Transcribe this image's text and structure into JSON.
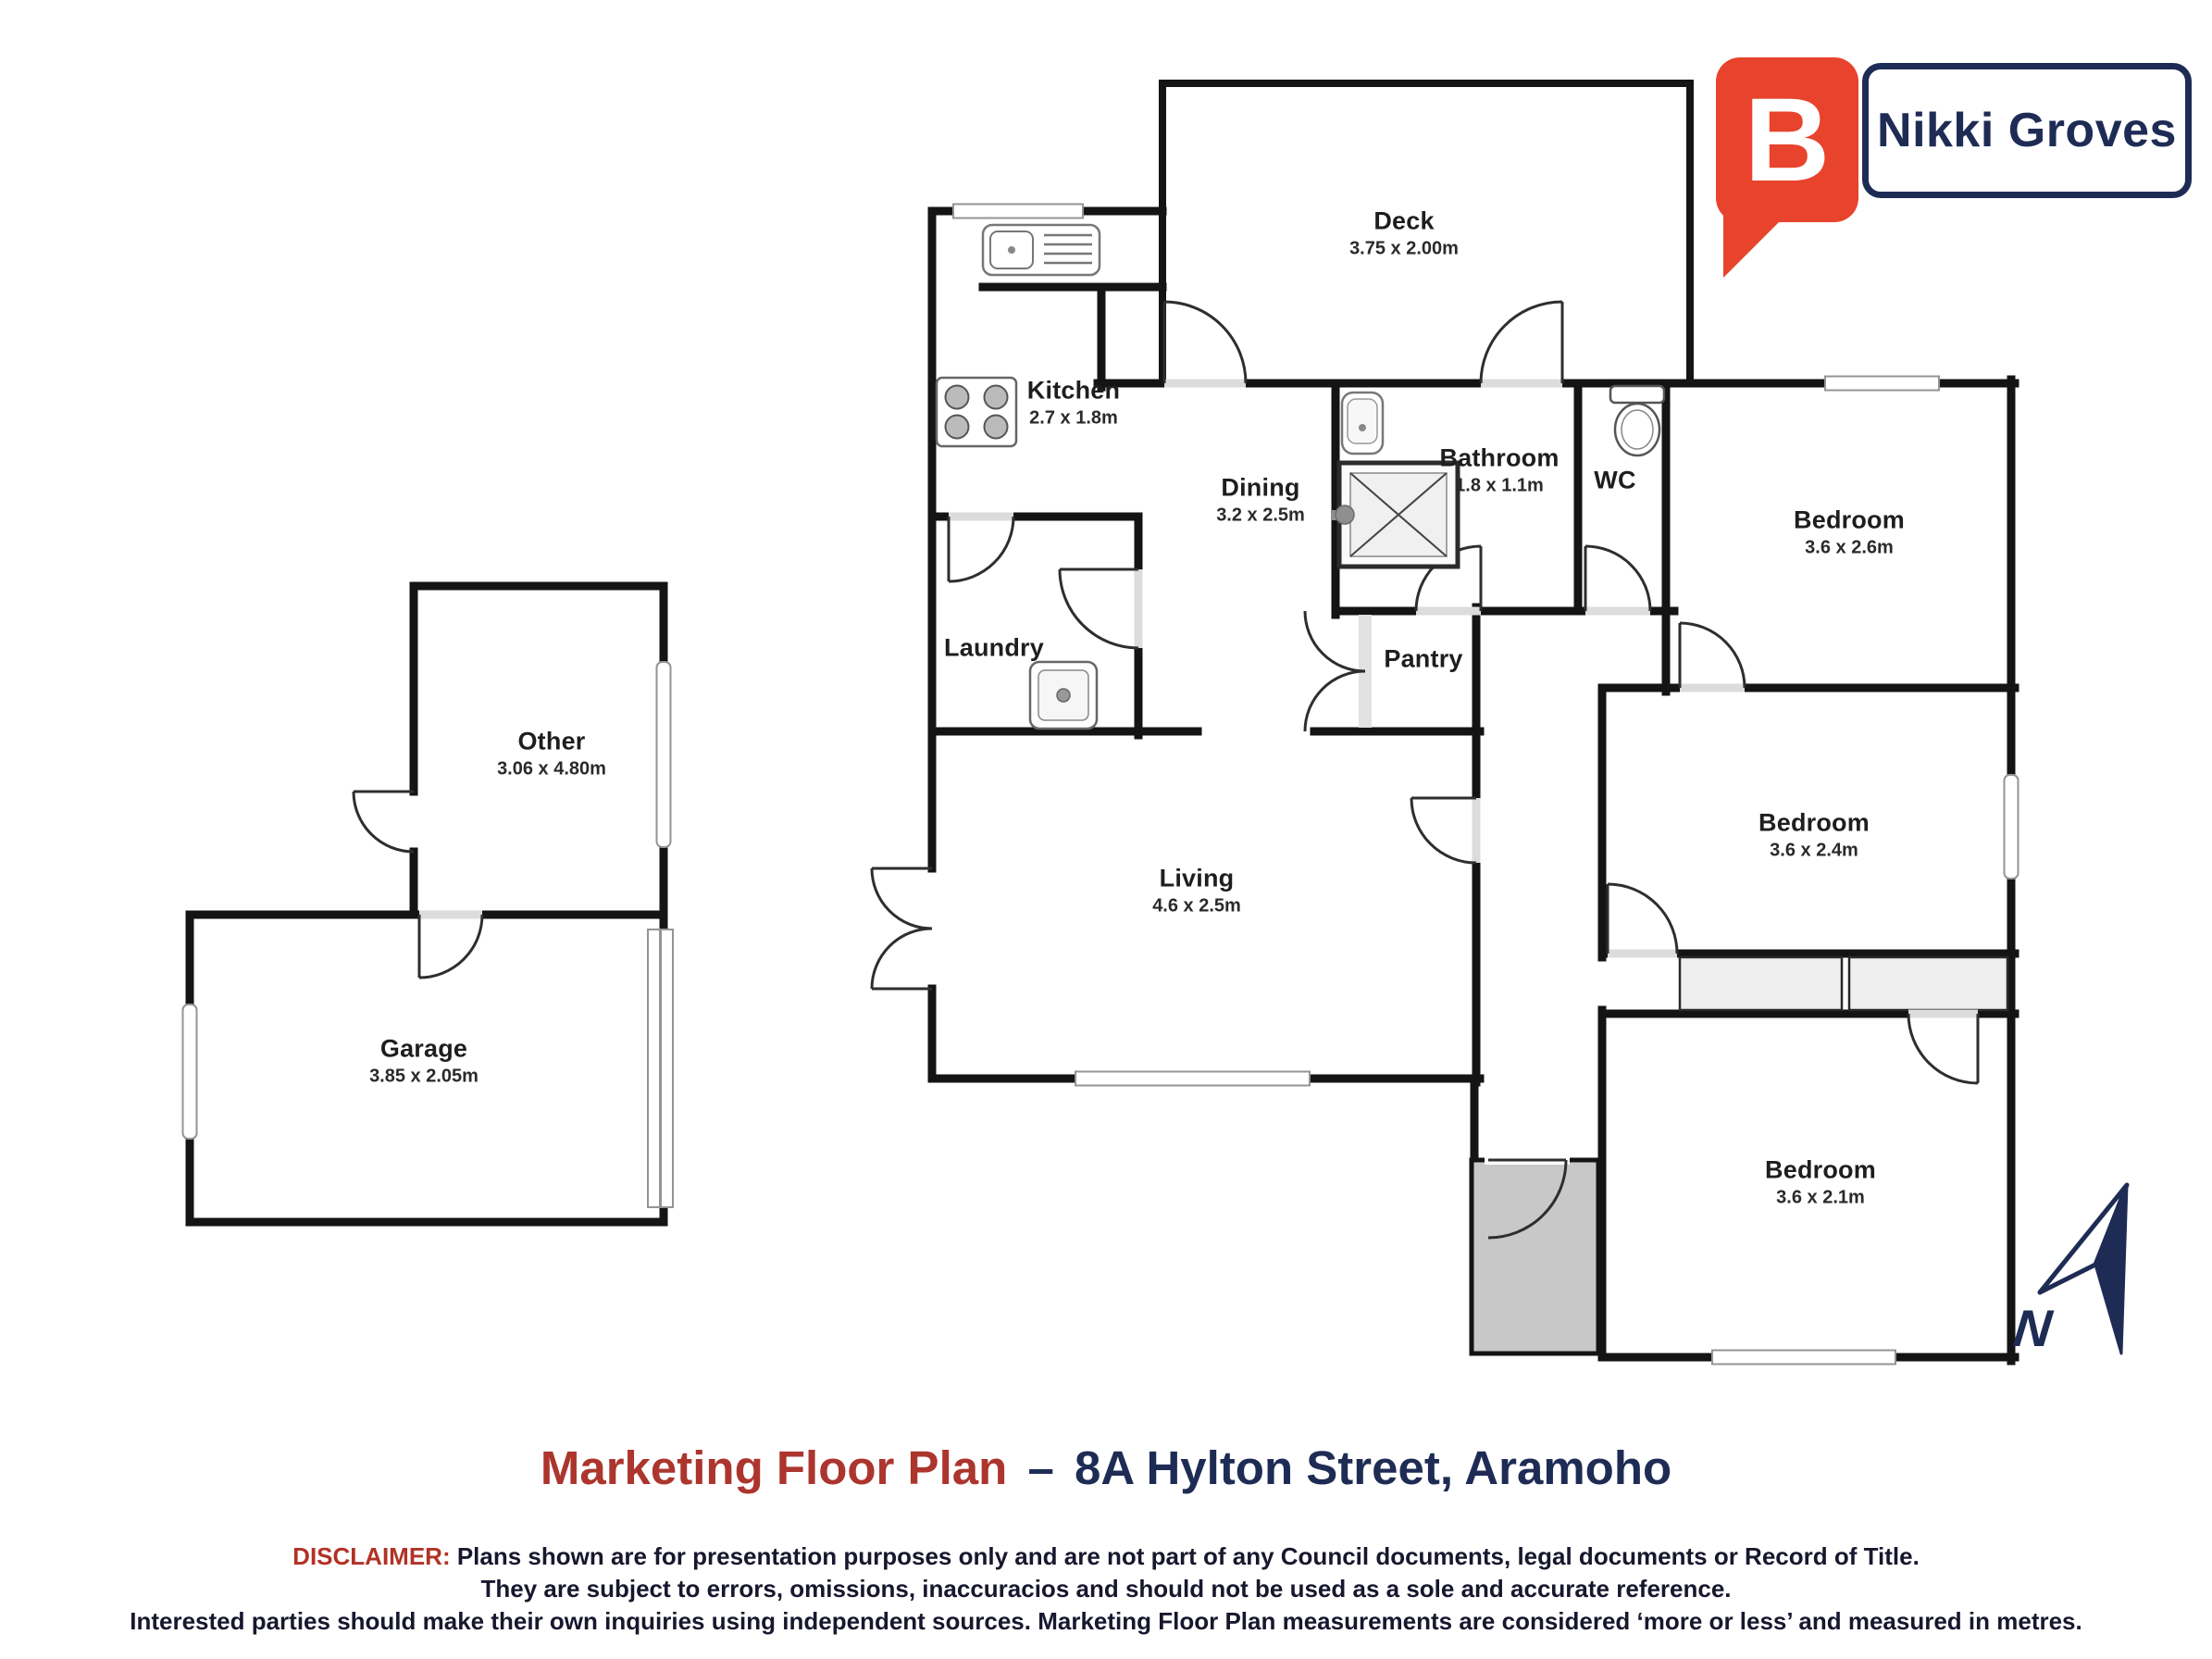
{
  "brand": {
    "name": "Nikki Groves",
    "logo_letter": "B",
    "logo_color": "#e8432c",
    "border_color": "#1e2c55"
  },
  "title": {
    "prefix": "Marketing Floor Plan",
    "separator": "–",
    "address": "8A Hylton Street, Aramoho",
    "prefix_color": "#ac352e",
    "address_color": "#1e2c55"
  },
  "disclaimer": {
    "label": "DISCLAIMER:",
    "line1": " Plans shown are for presentation purposes only and are not part of any Council documents, legal documents or Record of Title.",
    "line2": "They are subject to errors, omissions, inaccuracios and should not be used as a sole and accurate reference.",
    "line3": "Interested parties should make their own inquiries using independent sources. Marketing Floor Plan measurements are considered ‘more or less’ and measured in metres."
  },
  "compass": {
    "label": "N"
  },
  "rooms": [
    {
      "name": "Deck",
      "dims": "3.75 x 2.00m"
    },
    {
      "name": "Kitchen",
      "dims": "2.7 x 1.8m"
    },
    {
      "name": "Dining",
      "dims": "3.2 x 2.5m"
    },
    {
      "name": "Bathroom",
      "dims": "1.8 x 1.1m"
    },
    {
      "name": "WC",
      "dims": ""
    },
    {
      "name": "Bedroom",
      "dims": "3.6 x 2.6m"
    },
    {
      "name": "Laundry",
      "dims": ""
    },
    {
      "name": "Pantry",
      "dims": ""
    },
    {
      "name": "Living",
      "dims": "4.6 x 2.5m"
    },
    {
      "name": "Bedroom",
      "dims": "3.6 x 2.4m"
    },
    {
      "name": "Bedroom",
      "dims": "3.6 x 2.1m"
    },
    {
      "name": "Other",
      "dims": "3.06 x 4.80m"
    },
    {
      "name": "Garage",
      "dims": "3.85 x 2.05m"
    }
  ]
}
